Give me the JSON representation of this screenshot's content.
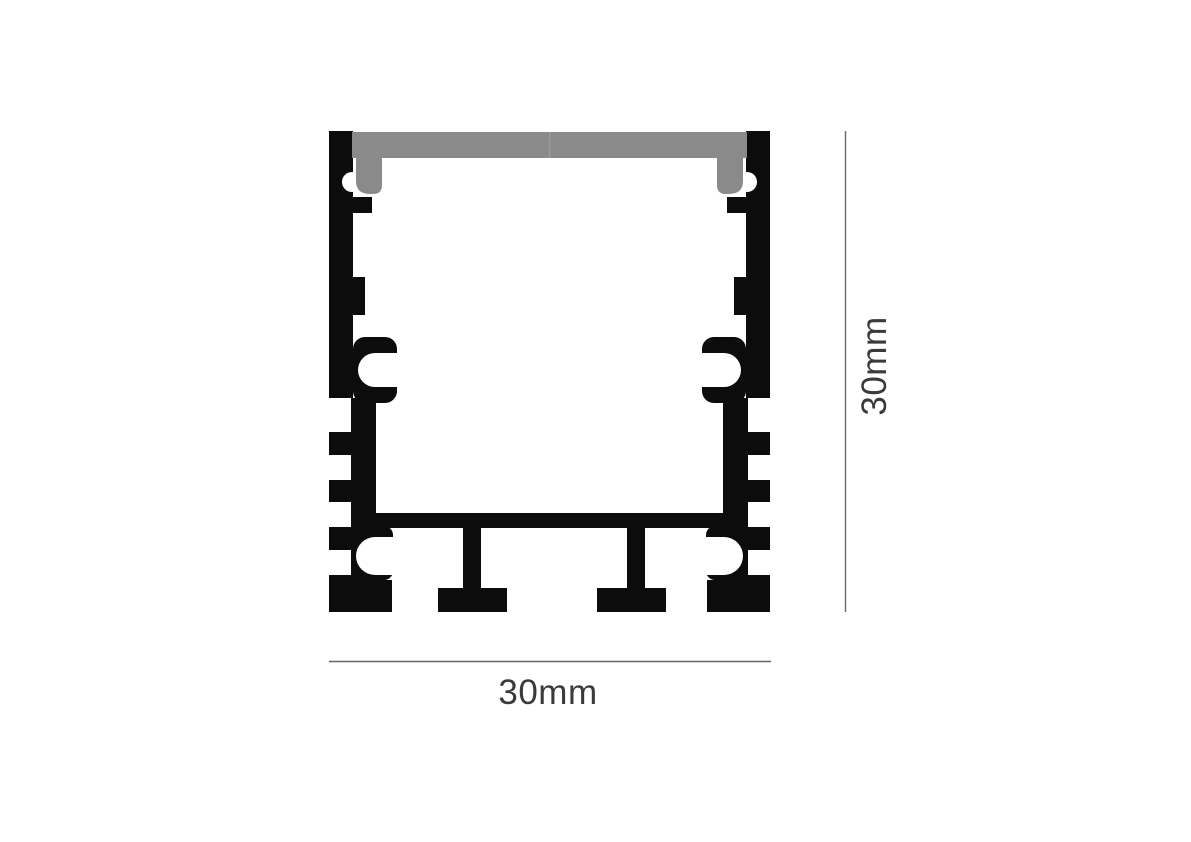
{
  "diagram": {
    "dimensions": {
      "width_label": "30mm",
      "height_label": "30mm"
    },
    "colors": {
      "profile": "#0c0c0c",
      "diffuser": "#8a8a8a",
      "diffuser_seam": "#9c9c9c",
      "cavity": "#ffffff",
      "dimension_line": "#666666",
      "label_text": "#3a3a3a",
      "background": "#ffffff"
    }
  }
}
